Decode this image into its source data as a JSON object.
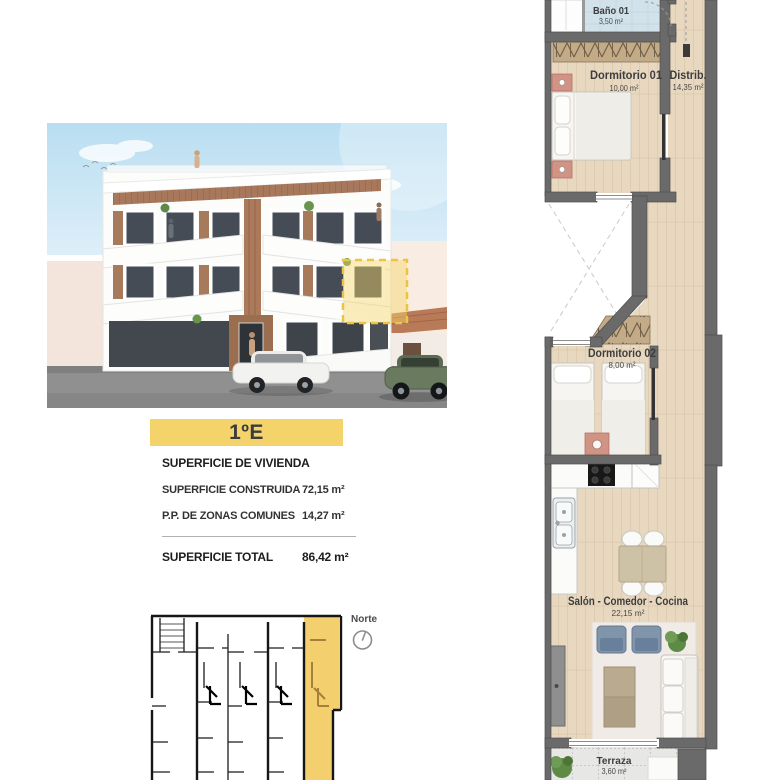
{
  "unit": {
    "label": "1ºE"
  },
  "surfaces": {
    "title": "SUPERFICIE DE VIVIENDA",
    "rows": [
      {
        "label": "SUPERFICIE CONSTRUIDA",
        "value": "72,15 m²"
      },
      {
        "label": "P.P. DE ZONAS COMUNES",
        "value": "14,27 m²"
      }
    ],
    "total_label": "SUPERFICIE TOTAL",
    "total_value": "86,42 m²"
  },
  "compass": {
    "label": "Norte"
  },
  "floorplan": {
    "rooms": [
      {
        "name": "Baño 01",
        "area": "3,50 m²"
      },
      {
        "name": "Dormitorio 01",
        "area": "10,00 m²"
      },
      {
        "name": "Distrib.",
        "area": "14,35 m²"
      },
      {
        "name": "Dormitorio 02",
        "area": "8,00 m²"
      },
      {
        "name": "Salón - Comedor - Cocina",
        "area": "22,15 m²"
      },
      {
        "name": "Terraza",
        "area": "3,60 m²"
      }
    ]
  },
  "colors": {
    "accent_yellow": "#f4d36a",
    "highlight_dash": "#ecc445",
    "wall_gray": "#6a6a6a",
    "wood_floor": "#e8d8c0",
    "bath_floor": "#d2e2ea",
    "keyplan_highlight": "#f3cf6e"
  }
}
